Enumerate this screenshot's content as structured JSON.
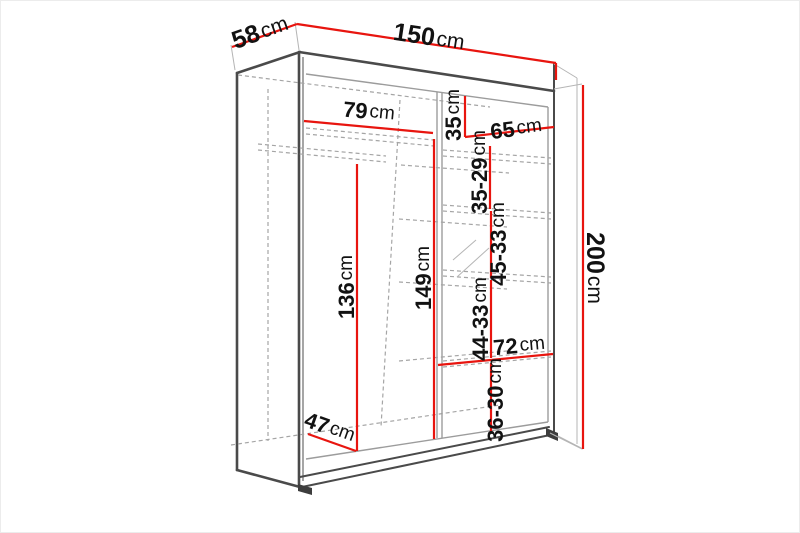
{
  "diagram": {
    "type": "wardrobe-dimension-drawing",
    "unit": "cm",
    "colors": {
      "dimension_line": "#e8150f",
      "outline": "#4a4a4a",
      "hidden_line": "#a5a5a5",
      "label_text": "#121212"
    },
    "dimensions": {
      "depth": {
        "num": "58",
        "unit": "cm"
      },
      "width": {
        "num": "150",
        "unit": "cm"
      },
      "height": {
        "num": "200",
        "unit": "cm"
      },
      "left_shelf_width": {
        "num": "79",
        "unit": "cm"
      },
      "top_right_height": {
        "num": "35",
        "unit": "cm"
      },
      "right_shelf_width": {
        "num": "65",
        "unit": "cm"
      },
      "right_gap_1": {
        "num": "35-29",
        "unit": "cm"
      },
      "right_gap_2": {
        "num": "45-33",
        "unit": "cm"
      },
      "middle_height": {
        "num": "149",
        "unit": "cm"
      },
      "hanging_height": {
        "num": "136",
        "unit": "cm"
      },
      "right_gap_3": {
        "num": "44-33",
        "unit": "cm"
      },
      "lower_shelf_width": {
        "num": "72",
        "unit": "cm"
      },
      "right_gap_4": {
        "num": "36-30",
        "unit": "cm"
      },
      "interior_depth": {
        "num": "47",
        "unit": "cm"
      }
    }
  }
}
